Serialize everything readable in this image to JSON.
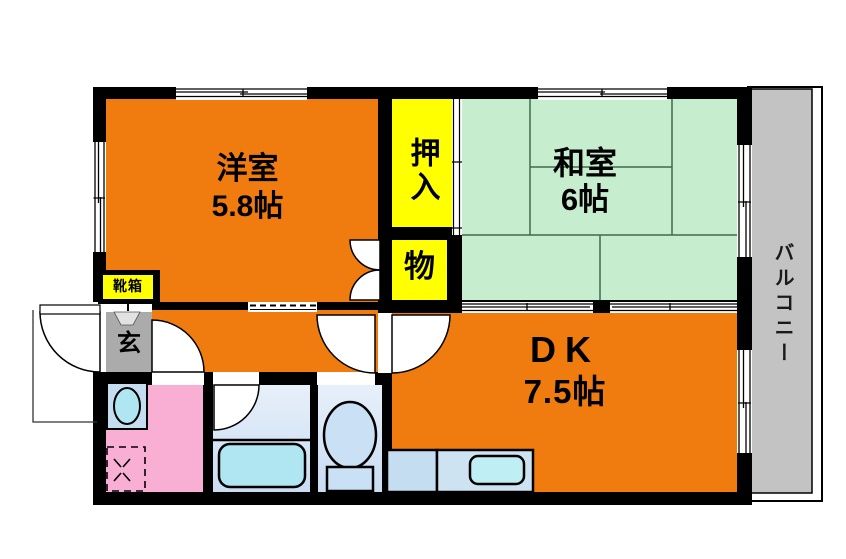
{
  "plan": {
    "title": "2DK apartment floor plan",
    "rooms": {
      "western_room": {
        "name": "洋室",
        "size": "5.8帖"
      },
      "japanese_room": {
        "name": "和室",
        "size": "6帖"
      },
      "dining_kitchen": {
        "name": "DK",
        "size": "7.5帖"
      },
      "closet_oshiire": {
        "label": "押入"
      },
      "closet_storage": {
        "label": "物"
      },
      "balcony": {
        "label": "バルコニー"
      },
      "entrance": {
        "label": "玄"
      },
      "shoe_box": {
        "label": "靴箱"
      }
    },
    "icons": {
      "bathtub": "rounded-rect-shape",
      "toilet": "ellipse-with-tank-shape",
      "kitchen-sink": "rounded-rect-shape",
      "wash-basin": "oval-in-square-shape",
      "washing-machine-space": "dashed-square-shape",
      "door-swing": "quarter-circle-arc",
      "sliding-door": "double-line-track",
      "window": "triple-line-band"
    },
    "colors": {
      "room-orange": "#F07C10",
      "tatami-green": "#C6EDCE",
      "tatami-line": "#3E6B4E",
      "closet-yellow": "#FFFF00",
      "balcony-gray": "#C3C3C3",
      "entrance-gray": "#ABABAB",
      "washroom-pink": "#F9AED3",
      "wetroom-blue-1": "#E7F0FA",
      "wetroom-blue-2": "#C9DCF2",
      "fixture-blue": "#B0E6F2",
      "counter-blue": "#CEE3F2",
      "cabinet-blue": "#C5DDF0",
      "wall-black": "#000000"
    }
  }
}
